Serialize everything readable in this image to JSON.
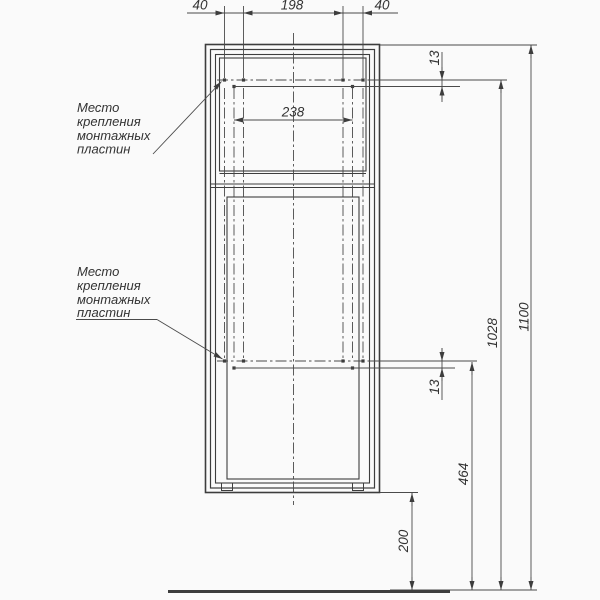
{
  "page": {
    "background": "#fafafa"
  },
  "drawing": {
    "type": "technical-drawing",
    "subject": "cabinet front view with mounting plate locations",
    "line_color": "#3d3d3d",
    "text_color": "#333333",
    "notes": {
      "upper": {
        "lines": [
          "Место",
          "крепления",
          "монтажных",
          "пластин"
        ]
      },
      "lower": {
        "lines": [
          "Место",
          "крепления",
          "монтажных",
          "пластин"
        ]
      }
    },
    "dimensions": {
      "top_left": "40",
      "top_center": "198",
      "top_right": "40",
      "plate_span": "238",
      "upper_row_offset": "13",
      "lower_row_offset": "13",
      "upper_plate_to_floor": "1028",
      "overall_height": "1100",
      "lower_plate_to_floor": "464",
      "cabinet_bottom_to_floor": "200"
    }
  }
}
